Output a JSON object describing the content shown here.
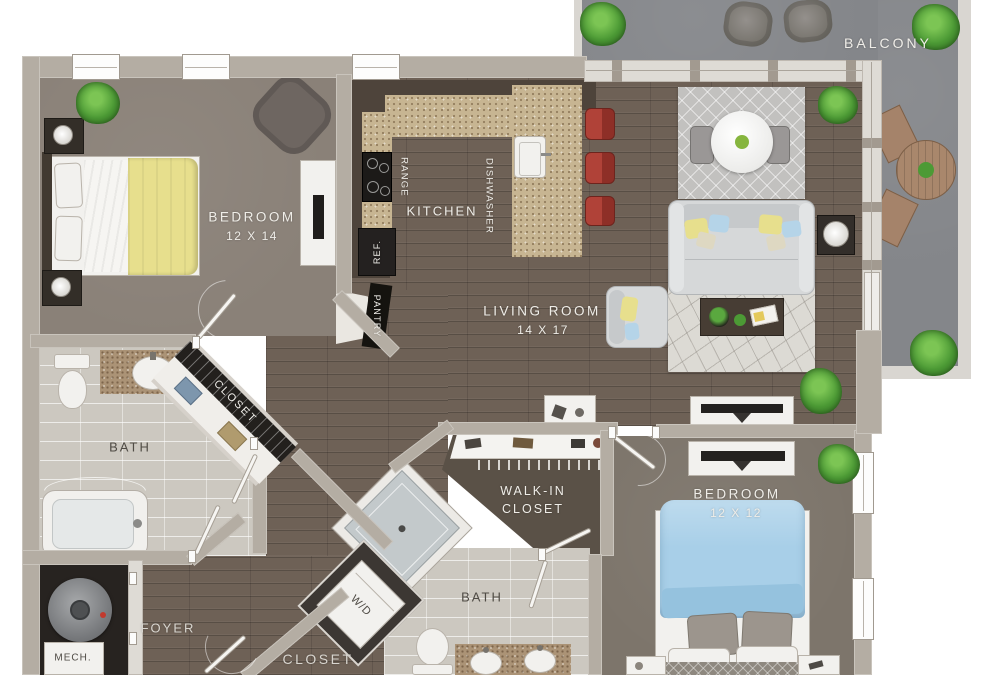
{
  "rooms": {
    "balcony": {
      "label": "BALCONY"
    },
    "bedroom1": {
      "label": "BEDROOM",
      "dims": "12 X 14"
    },
    "kitchen": {
      "label": "KITCHEN",
      "appliances": {
        "range": "RANGE",
        "dishwasher": "DISHWASHER",
        "refrigerator": "REF.",
        "pantry": "PANTRY"
      }
    },
    "living": {
      "label": "LIVING ROOM",
      "dims": "14 X 17"
    },
    "bedroom1_closet": {
      "label": "CLOSET"
    },
    "bath1": {
      "label": "BATH"
    },
    "walkin_closet": {
      "line1": "WALK-IN",
      "line2": "CLOSET"
    },
    "bedroom2": {
      "label": "BEDROOM",
      "dims": "12 X 12"
    },
    "bath2": {
      "label": "BATH"
    },
    "laundry": {
      "label": "W/D"
    },
    "foyer": {
      "label": "FOYER"
    },
    "mech": {
      "label": "MECH."
    },
    "entry_closet": {
      "label": "CLOSET"
    }
  },
  "colors": {
    "wood_floor": "#6e6156",
    "carpet_bedroom_1": "#8a8178",
    "carpet_bedroom_2": "#7d756b",
    "bath_tile": "#ccc8c0",
    "balcony_concrete": "#84868a",
    "wall": "#b4ada3",
    "counter_granite": "#c7b592",
    "cabinet_dark": "#4e443b",
    "bed1_yellow": "#e7df8d",
    "bed2_blue": "#a8cfe8",
    "stool_red": "#a83b31",
    "plant_green": "#4c9a35",
    "label_light": "#efede8",
    "label_dark": "#4f4b45",
    "walkin_floor": "#5a5147",
    "closet_dark": "#23201d"
  }
}
